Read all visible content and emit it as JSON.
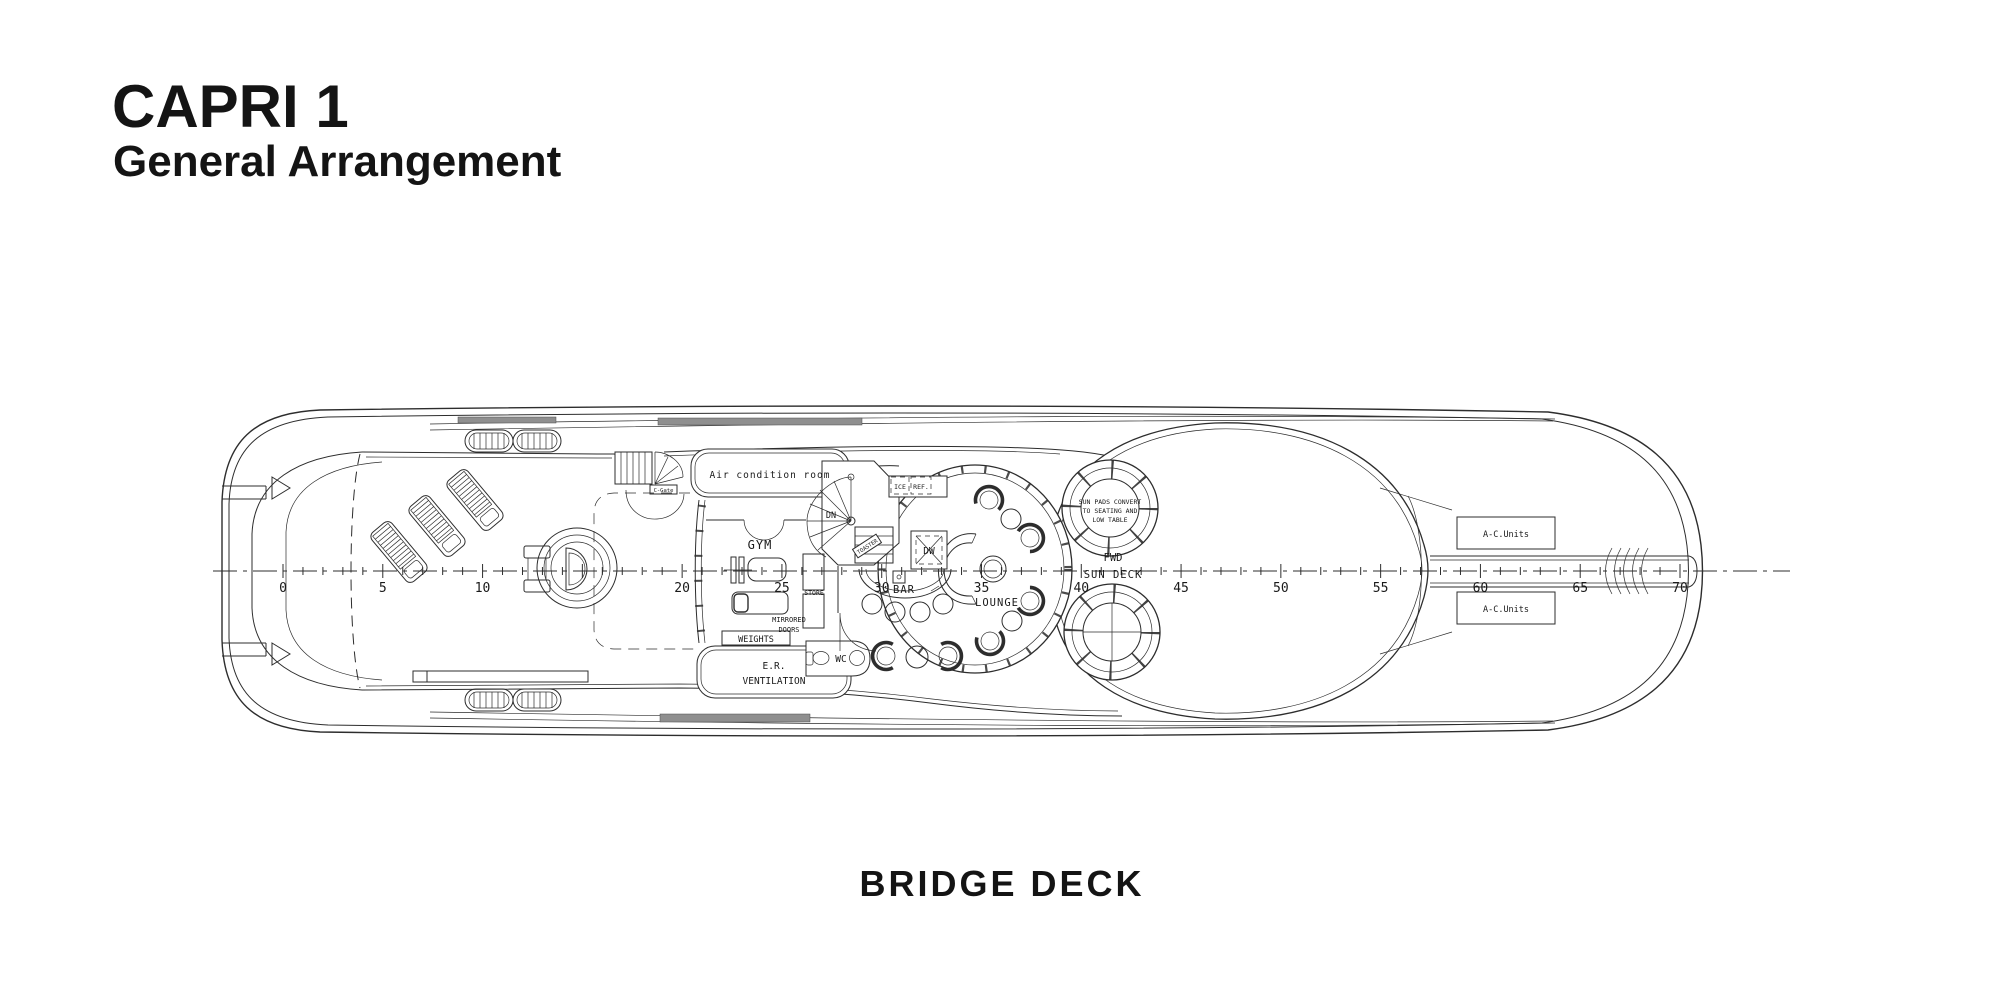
{
  "header": {
    "title": "CAPRI 1",
    "subtitle": "General Arrangement"
  },
  "footer": {
    "deck_label": "BRIDGE DECK"
  },
  "labels": {
    "air_condition_room": "Air condition room",
    "dn": "DN",
    "ice": "ICE",
    "ref": "REF.",
    "gym": "GYM",
    "store": "STORE",
    "mirrored": "MIRRORED",
    "doors": "DOORS",
    "weights": "WEIGHTS",
    "er_line1": "E.R.",
    "er_line2": "VENTILATION",
    "wc": "WC",
    "toaster": "TOASTER",
    "dw": "DW",
    "bar": "BAR",
    "lounge": "LOUNGE",
    "c_gate": "C-Gate",
    "sun_pads_1": "SUN PADS CONVERT",
    "sun_pads_2": "TO SEATING AND",
    "sun_pads_3": "LOW TABLE",
    "fwd": "FWD",
    "sun_deck": "SUN DECK",
    "ac_units": "A-C.Units"
  },
  "ruler": {
    "unit_labels": [
      0,
      5,
      10,
      20,
      25,
      30,
      35,
      40,
      45,
      50,
      55,
      60,
      65,
      70
    ]
  },
  "colors": {
    "ink": "#2d2d2d",
    "text": "#141414",
    "background": "#ffffff"
  }
}
